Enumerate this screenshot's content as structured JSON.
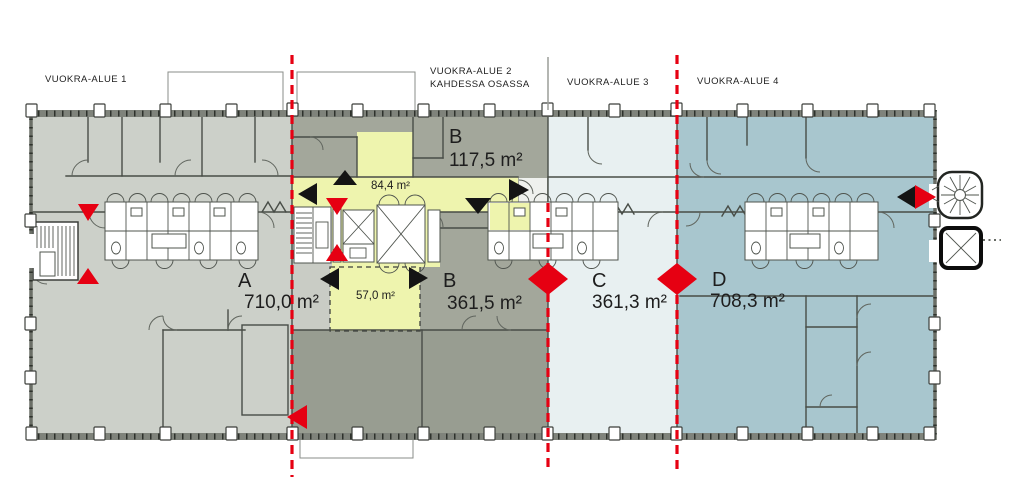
{
  "labels": {
    "zone1": "VUOKRA-ALUE 1",
    "zone2_line1": "VUOKRA-ALUE 2",
    "zone2_line2": "KAHDESSA OSASSA",
    "zone3": "VUOKRA-ALUE 3",
    "zone4": "VUOKRA-ALUE 4"
  },
  "units": {
    "a": {
      "letter": "A",
      "area": "710,0 m²"
    },
    "b_upper": {
      "letter": "B",
      "area": "117,5 m²"
    },
    "b_lower": {
      "letter": "B",
      "area": "361,5 m²"
    },
    "c": {
      "letter": "C",
      "area": "361,3 m²"
    },
    "d": {
      "letter": "D",
      "area": "708,3 m²"
    }
  },
  "highlights": {
    "corridor_area": "84,4 m²",
    "block_area": "57,0 m²"
  },
  "colors": {
    "zone1": "#ccd0c9",
    "zone2": "#a3a79b",
    "zone2_dark": "#989d91",
    "zone2_light": "#c9ccc5",
    "zone3": "#e8f0f1",
    "zone4": "#a8c6ce",
    "highlight": "#eef4ae",
    "red": "#e60012",
    "black": "#141414"
  }
}
